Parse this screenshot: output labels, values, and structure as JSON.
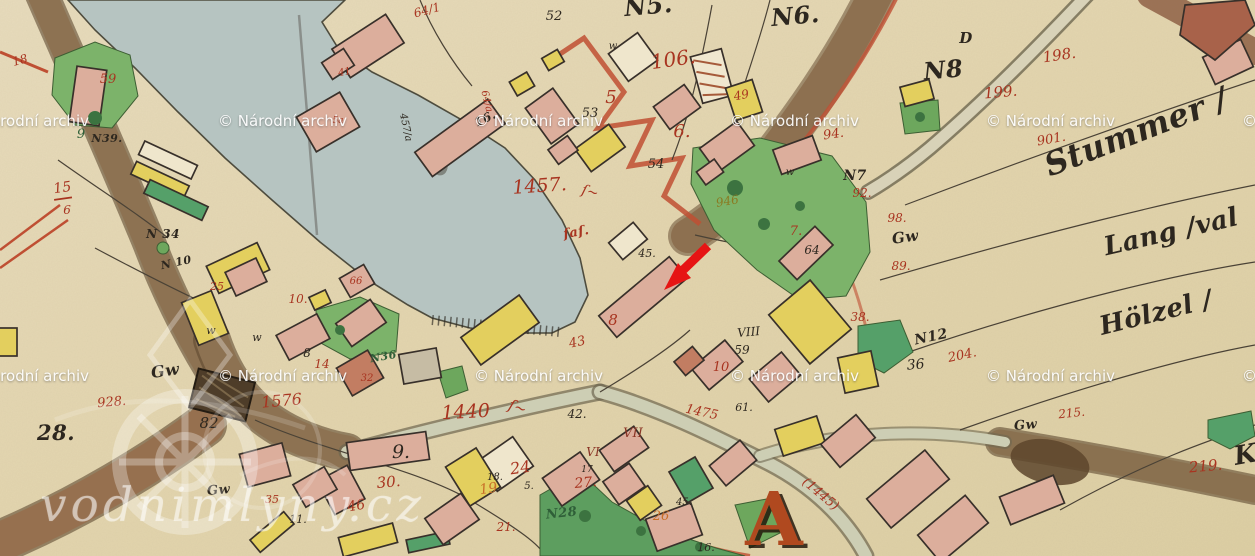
{
  "watermark_archive": {
    "text": "© Národní archiv",
    "color": "#ffffff",
    "positions": [
      {
        "x": -40,
        "y": 112
      },
      {
        "x": 218,
        "y": 112
      },
      {
        "x": 474,
        "y": 112
      },
      {
        "x": 730,
        "y": 112
      },
      {
        "x": 986,
        "y": 112
      },
      {
        "x": 1242,
        "y": 112
      },
      {
        "x": -40,
        "y": 367
      },
      {
        "x": 218,
        "y": 367
      },
      {
        "x": 474,
        "y": 367
      },
      {
        "x": 730,
        "y": 367
      },
      {
        "x": 986,
        "y": 367
      },
      {
        "x": 1242,
        "y": 367
      }
    ]
  },
  "watermark_site": {
    "text": "vodnimlyny.cz",
    "opacity": 0.45
  },
  "annotation": {
    "arrow_color": "#e61414"
  },
  "palette": {
    "paper": "#e5d8b5",
    "water": "#b6c4c1",
    "road_brown": "#8d7252",
    "vermillion": "#bf4f33",
    "pink": "#dcae9c",
    "yellow": "#e3cf5e",
    "meadow": "#7cb36a",
    "teal": "#55a069",
    "red": "#a83420",
    "ink": "#2d271f",
    "orange": "#c96e28",
    "green": "#2f5f38",
    "olive": "#8a7a22",
    "darkred": "#8a3526",
    "rust": "#b0491f"
  },
  "map_labels": [
    {
      "t": "N5.",
      "x": 649,
      "y": 14,
      "s": 24,
      "c": "ink",
      "f": "script",
      "r": -5
    },
    {
      "t": "106.",
      "x": 674,
      "y": 66,
      "s": 20,
      "c": "red",
      "r": -8
    },
    {
      "t": "N6.",
      "x": 796,
      "y": 24,
      "s": 24,
      "c": "ink",
      "f": "script",
      "r": -5
    },
    {
      "t": "D",
      "x": 966,
      "y": 43,
      "s": 15,
      "c": "ink",
      "f": "script"
    },
    {
      "t": "N8",
      "x": 944,
      "y": 78,
      "s": 24,
      "c": "ink",
      "f": "script",
      "r": -5
    },
    {
      "t": "198.",
      "x": 1060,
      "y": 60,
      "s": 15,
      "c": "red",
      "r": -8
    },
    {
      "t": "199.",
      "x": 1001,
      "y": 97,
      "s": 15,
      "c": "red",
      "r": -5
    },
    {
      "t": "901.",
      "x": 1052,
      "y": 143,
      "s": 13,
      "c": "red",
      "r": -10
    },
    {
      "t": "Stummer /",
      "x": 1140,
      "y": 142,
      "s": 32,
      "c": "ink",
      "f": "script",
      "r": -21
    },
    {
      "t": "Lang /val",
      "x": 1173,
      "y": 240,
      "s": 26,
      "c": "ink",
      "f": "script",
      "r": -13
    },
    {
      "t": "Hölzel /",
      "x": 1158,
      "y": 321,
      "s": 26,
      "c": "ink",
      "f": "script",
      "r": -14
    },
    {
      "t": "K",
      "x": 1247,
      "y": 463,
      "s": 26,
      "c": "ink",
      "f": "script",
      "r": -10
    },
    {
      "t": "219.",
      "x": 1206,
      "y": 471,
      "s": 15,
      "c": "red",
      "r": -5
    },
    {
      "t": "N7",
      "x": 855,
      "y": 180,
      "s": 14,
      "c": "ink",
      "f": "script"
    },
    {
      "t": "92.",
      "x": 862,
      "y": 197,
      "s": 12,
      "c": "red"
    },
    {
      "t": "98.",
      "x": 897,
      "y": 222,
      "s": 12,
      "c": "red"
    },
    {
      "t": "89.",
      "x": 901,
      "y": 270,
      "s": 12,
      "c": "red"
    },
    {
      "t": "Gw",
      "x": 906,
      "y": 242,
      "s": 15,
      "c": "ink",
      "f": "script",
      "r": -8
    },
    {
      "t": "N12",
      "x": 932,
      "y": 341,
      "s": 14,
      "c": "ink",
      "f": "script",
      "r": -12
    },
    {
      "t": "204.",
      "x": 963,
      "y": 359,
      "s": 13,
      "c": "red",
      "r": -12
    },
    {
      "t": "36",
      "x": 916,
      "y": 369,
      "s": 14,
      "c": "ink",
      "r": -5
    },
    {
      "t": "38.",
      "x": 860,
      "y": 321,
      "s": 12,
      "c": "red"
    },
    {
      "t": "215.",
      "x": 1072,
      "y": 417,
      "s": 12,
      "c": "red",
      "r": -6
    },
    {
      "t": "Gw",
      "x": 1026,
      "y": 429,
      "s": 13,
      "c": "ink",
      "f": "script",
      "r": -5
    },
    {
      "t": "64/1",
      "x": 428,
      "y": 14,
      "s": 12,
      "c": "red",
      "r": -15
    },
    {
      "t": "52",
      "x": 554,
      "y": 20,
      "s": 13,
      "c": "ink"
    },
    {
      "t": "5",
      "x": 611,
      "y": 103,
      "s": 18,
      "c": "red"
    },
    {
      "t": "53",
      "x": 590,
      "y": 117,
      "s": 13,
      "c": "ink"
    },
    {
      "t": "6.",
      "x": 682,
      "y": 137,
      "s": 18,
      "c": "red"
    },
    {
      "t": "54",
      "x": 656,
      "y": 168,
      "s": 13,
      "c": "ink"
    },
    {
      "t": "49",
      "x": 742,
      "y": 99,
      "s": 12,
      "c": "red",
      "r": -10
    },
    {
      "t": "94.",
      "x": 834,
      "y": 138,
      "s": 13,
      "c": "red",
      "r": -8
    },
    {
      "t": "64/a",
      "x": 484,
      "y": 102,
      "s": 10,
      "c": "red",
      "r": 76
    },
    {
      "t": "457/a",
      "x": 403,
      "y": 128,
      "s": 10,
      "c": "ink",
      "r": 78
    },
    {
      "t": "16.",
      "x": 487,
      "y": 122,
      "s": 12,
      "c": "ink",
      "f": "script",
      "r": -25
    },
    {
      "t": "1457.",
      "x": 540,
      "y": 192,
      "s": 19,
      "c": "red",
      "r": -4
    },
    {
      "t": "ſ~",
      "x": 589,
      "y": 196,
      "s": 14,
      "c": "red",
      "r": 15
    },
    {
      "t": "ſaſ.",
      "x": 577,
      "y": 236,
      "s": 13,
      "c": "red",
      "f": "script",
      "r": -10
    },
    {
      "t": "946",
      "x": 728,
      "y": 205,
      "s": 12,
      "c": "olive",
      "r": -10
    },
    {
      "t": "45.",
      "x": 647,
      "y": 257,
      "s": 11,
      "c": "ink"
    },
    {
      "t": "64",
      "x": 812,
      "y": 254,
      "s": 12,
      "c": "ink"
    },
    {
      "t": "7.",
      "x": 796,
      "y": 235,
      "s": 13,
      "c": "red"
    },
    {
      "t": "8",
      "x": 613,
      "y": 325,
      "s": 15,
      "c": "red"
    },
    {
      "t": "43",
      "x": 578,
      "y": 346,
      "s": 13,
      "c": "red",
      "r": -12
    },
    {
      "t": "VIII",
      "x": 749,
      "y": 336,
      "s": 12,
      "c": "ink",
      "r": -5
    },
    {
      "t": "59",
      "x": 742,
      "y": 354,
      "s": 12,
      "c": "ink"
    },
    {
      "t": "10",
      "x": 721,
      "y": 371,
      "s": 13,
      "c": "red"
    },
    {
      "t": "42.",
      "x": 577,
      "y": 418,
      "s": 12,
      "c": "ink"
    },
    {
      "t": "61.",
      "x": 744,
      "y": 411,
      "s": 11,
      "c": "ink"
    },
    {
      "t": "1475",
      "x": 701,
      "y": 416,
      "s": 13,
      "c": "red",
      "r": 12
    },
    {
      "t": "(1445)",
      "x": 818,
      "y": 497,
      "s": 13,
      "c": "red",
      "r": 40
    },
    {
      "t": "A",
      "x": 774,
      "y": 545,
      "s": 74,
      "c": "rust",
      "f": "display shadowed"
    },
    {
      "t": "VII",
      "x": 633,
      "y": 437,
      "s": 13,
      "c": "darkred"
    },
    {
      "t": "VI",
      "x": 593,
      "y": 456,
      "s": 12,
      "c": "darkred"
    },
    {
      "t": "1440",
      "x": 466,
      "y": 418,
      "s": 19,
      "c": "red",
      "r": -3
    },
    {
      "t": "ſ~",
      "x": 516,
      "y": 412,
      "s": 15,
      "c": "red",
      "r": 20
    },
    {
      "t": "24",
      "x": 521,
      "y": 473,
      "s": 16,
      "c": "red",
      "r": -8
    },
    {
      "t": "18.",
      "x": 495,
      "y": 480,
      "s": 10,
      "c": "ink"
    },
    {
      "t": "19",
      "x": 489,
      "y": 493,
      "s": 14,
      "c": "orange",
      "r": -8
    },
    {
      "t": "5.",
      "x": 529,
      "y": 489,
      "s": 10,
      "c": "ink"
    },
    {
      "t": "27.",
      "x": 586,
      "y": 487,
      "s": 14,
      "c": "red",
      "r": -5
    },
    {
      "t": "17",
      "x": 587,
      "y": 472,
      "s": 9,
      "c": "ink"
    },
    {
      "t": "21.",
      "x": 506,
      "y": 531,
      "s": 12,
      "c": "red"
    },
    {
      "t": "N28",
      "x": 562,
      "y": 517,
      "s": 13,
      "c": "green",
      "f": "script",
      "r": -6
    },
    {
      "t": "26",
      "x": 661,
      "y": 520,
      "s": 13,
      "c": "orange"
    },
    {
      "t": "45.",
      "x": 684,
      "y": 505,
      "s": 10,
      "c": "ink"
    },
    {
      "t": "16.",
      "x": 706,
      "y": 551,
      "s": 11,
      "c": "ink"
    },
    {
      "t": "9.",
      "x": 401,
      "y": 458,
      "s": 19,
      "c": "ink"
    },
    {
      "t": "30.",
      "x": 389,
      "y": 487,
      "s": 15,
      "c": "red",
      "r": -5
    },
    {
      "t": "46",
      "x": 357,
      "y": 510,
      "s": 14,
      "c": "red",
      "r": -10
    },
    {
      "t": "11.",
      "x": 298,
      "y": 523,
      "s": 11,
      "c": "ink"
    },
    {
      "t": "35",
      "x": 272,
      "y": 503,
      "s": 11,
      "c": "red"
    },
    {
      "t": "Gw",
      "x": 219,
      "y": 494,
      "s": 13,
      "c": "ink",
      "f": "script",
      "r": -5
    },
    {
      "t": "Gw",
      "x": 166,
      "y": 376,
      "s": 16,
      "c": "ink",
      "f": "script",
      "r": -8
    },
    {
      "t": "928.",
      "x": 112,
      "y": 406,
      "s": 13,
      "c": "red",
      "r": -5
    },
    {
      "t": "28.",
      "x": 56,
      "y": 440,
      "s": 21,
      "c": "ink",
      "f": "script"
    },
    {
      "t": "82",
      "x": 209,
      "y": 428,
      "s": 15,
      "c": "ink"
    },
    {
      "t": "1576",
      "x": 282,
      "y": 406,
      "s": 16,
      "c": "red",
      "r": -5
    },
    {
      "t": "N 34",
      "x": 163,
      "y": 238,
      "s": 12,
      "c": "ink",
      "f": "script"
    },
    {
      "t": "N39.",
      "x": 107,
      "y": 142,
      "s": 11,
      "c": "ink",
      "f": "script"
    },
    {
      "t": "59",
      "x": 108,
      "y": 83,
      "s": 13,
      "c": "red"
    },
    {
      "t": "9",
      "x": 81,
      "y": 138,
      "s": 13,
      "c": "green"
    },
    {
      "t": "15",
      "x": 63,
      "y": 192,
      "s": 14,
      "c": "red",
      "r": -8
    },
    {
      "t": "6",
      "x": 67,
      "y": 214,
      "s": 12,
      "c": "red"
    },
    {
      "t": "N 10",
      "x": 177,
      "y": 266,
      "s": 11,
      "c": "ink",
      "f": "script",
      "r": -12
    },
    {
      "t": "10.",
      "x": 298,
      "y": 303,
      "s": 12,
      "c": "red"
    },
    {
      "t": "25",
      "x": 217,
      "y": 290,
      "s": 11,
      "c": "red"
    },
    {
      "t": "8",
      "x": 307,
      "y": 357,
      "s": 12,
      "c": "ink"
    },
    {
      "t": "14",
      "x": 322,
      "y": 368,
      "s": 12,
      "c": "red"
    },
    {
      "t": "N36",
      "x": 384,
      "y": 360,
      "s": 11,
      "c": "green",
      "f": "script",
      "r": -10
    },
    {
      "t": "66",
      "x": 356,
      "y": 284,
      "s": 10,
      "c": "red"
    },
    {
      "t": "32",
      "x": 367,
      "y": 381,
      "s": 10,
      "c": "red"
    },
    {
      "t": "5a",
      "x": 338,
      "y": 123,
      "s": 9,
      "c": "red"
    },
    {
      "t": "41",
      "x": 345,
      "y": 75,
      "s": 10,
      "c": "red",
      "r": -10
    },
    {
      "t": "18",
      "x": 21,
      "y": 64,
      "s": 12,
      "c": "red",
      "r": -15
    },
    {
      "t": "w",
      "x": 211,
      "y": 334,
      "s": 11,
      "c": "ink"
    },
    {
      "t": "w",
      "x": 257,
      "y": 341,
      "s": 11,
      "c": "ink"
    },
    {
      "t": "w",
      "x": 613,
      "y": 49,
      "s": 10,
      "c": "ink"
    },
    {
      "t": "w",
      "x": 790,
      "y": 175,
      "s": 10,
      "c": "ink"
    }
  ]
}
